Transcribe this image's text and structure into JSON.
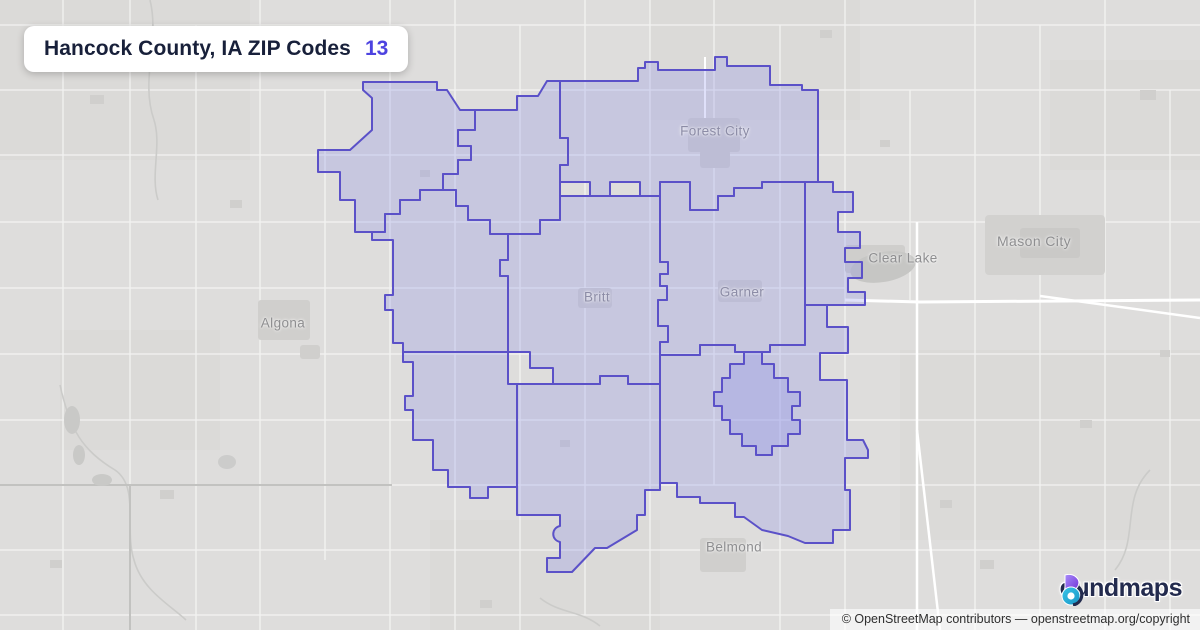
{
  "header": {
    "title": "Hancock County, IA ZIP Codes",
    "count": "13"
  },
  "map": {
    "zip_count": 13,
    "cities": [
      {
        "name": "Forest City"
      },
      {
        "name": "Clear Lake"
      },
      {
        "name": "Mason City"
      },
      {
        "name": "Algona"
      },
      {
        "name": "Britt"
      },
      {
        "name": "Garner"
      },
      {
        "name": "Belmond"
      }
    ],
    "colors": {
      "boundary": "#5b51c8",
      "zone_fill": "rgba(139,144,232,0.28)",
      "basemap": "#dedddc",
      "roads": "#ffffff",
      "water": "#c6c6c4",
      "accent": "#4d43e0"
    }
  },
  "branding": {
    "logo_first_letter": "b",
    "logo_text_rest": "oundmaps"
  },
  "attribution": {
    "text": "© OpenStreetMap contributors",
    "separator": " — ",
    "link": "openstreetmap.org/copyright"
  }
}
